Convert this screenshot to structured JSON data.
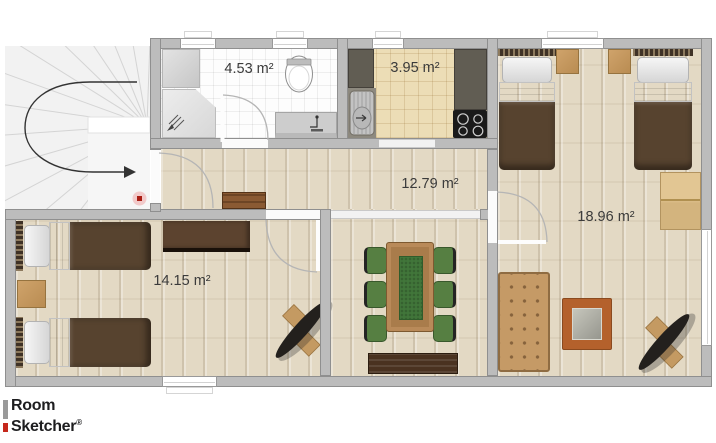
{
  "floorplan": {
    "rooms": [
      {
        "name": "bathroom",
        "area": "4.53 m²"
      },
      {
        "name": "kitchen",
        "area": "3.95 m²"
      },
      {
        "name": "hallway",
        "area": "12.79 m²"
      },
      {
        "name": "bedroom-right",
        "area": "18.96 m²"
      },
      {
        "name": "bedroom-left",
        "area": "14.15 m²"
      }
    ]
  },
  "brand": {
    "line1": "Room",
    "line2": "Sketcher",
    "registered": "®"
  },
  "colors": {
    "wall": "#bcbcbc",
    "wood_floor": "#e3d9c4",
    "tile_beige": "#ecddb6",
    "tile_white": "#fdfdfd",
    "blanket_brown": "#57432f",
    "chair_green": "#567f42",
    "table_wood": "#a97c4b",
    "runner_green": "#41763a",
    "sofa_tan": "#c59a66",
    "frame_rust": "#b4612c",
    "logo_red": "#c5281c",
    "logo_gray": "#9a9a9a",
    "label_text": "#3b3b3b",
    "arrow": "#333333",
    "stair_marker_red": "#aa1d13"
  }
}
